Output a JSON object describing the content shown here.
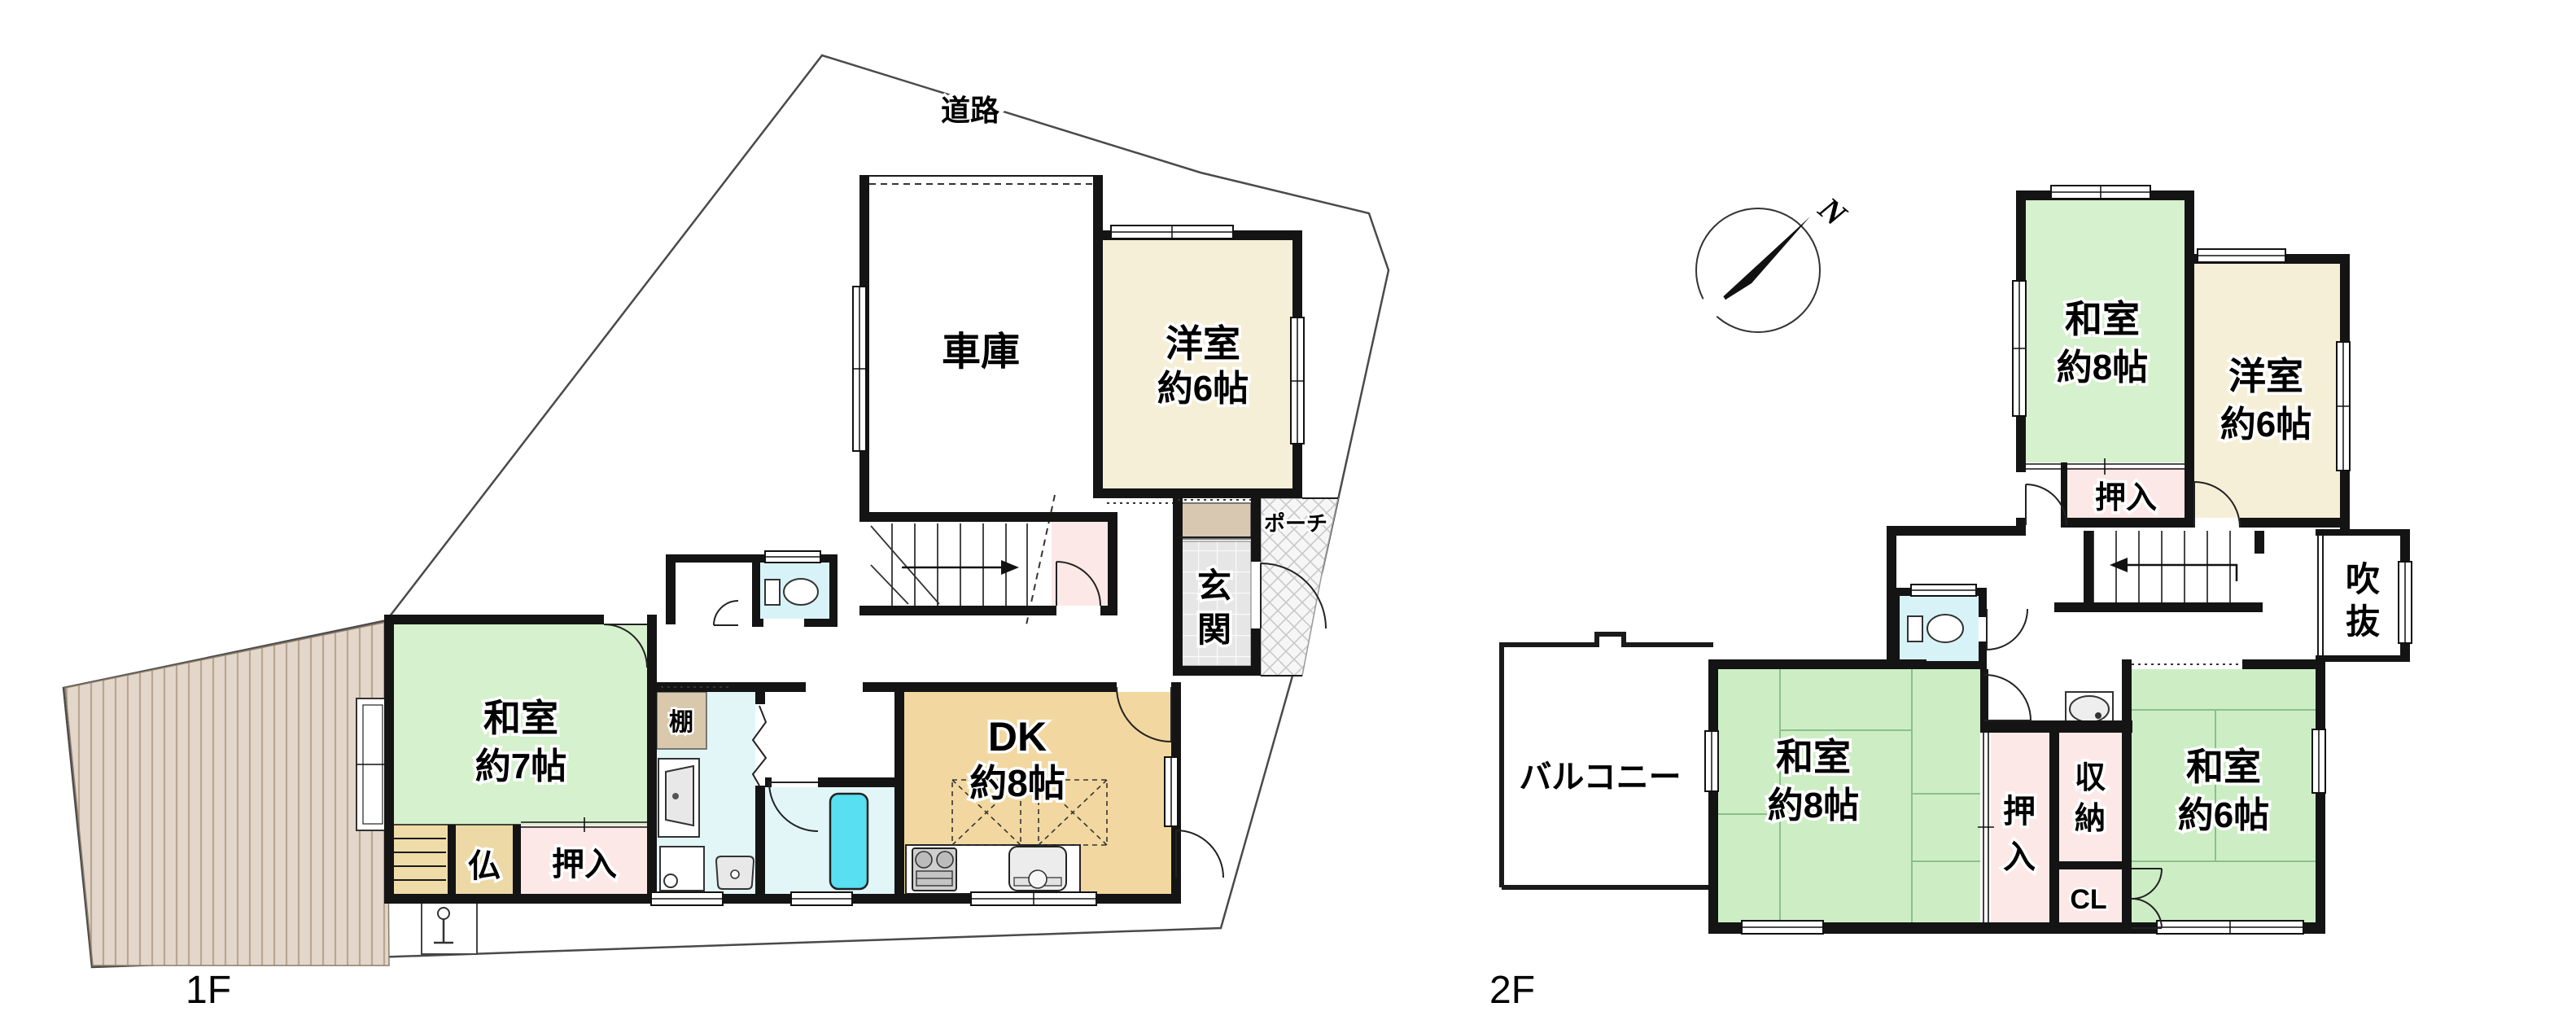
{
  "palette": {
    "wall": "#141414",
    "tatami_green": "#d5f1cd",
    "tatami_green_dark": "#cdeec5",
    "dk_wood": "#f2d8a0",
    "western_cream": "#f6efd7",
    "closet_pink": "#fce9e7",
    "toilet_cyan": "#d8f3f7",
    "wash_cyan": "#e2f6f8",
    "tub_cyan": "#58dff2",
    "shelf_tan": "#d9c8ac",
    "butsudan_tan": "#ecd9a6",
    "entry_tile": "#e6e6e6",
    "hatch_bg": "#e2d7ca",
    "hatch_line": "#b9a691"
  },
  "floor1": {
    "name": "1F",
    "road_label": "道路",
    "garage": "車庫",
    "western_room": {
      "line1": "洋室",
      "line2": "約6帖"
    },
    "dk": {
      "line1": "DK",
      "line2": "約8帖"
    },
    "japanese_room": {
      "line1": "和室",
      "line2": "約7帖"
    },
    "butsudan": "仏",
    "oshiire": "押入",
    "shelf": "棚",
    "genkan": {
      "line1": "玄",
      "line2": "関"
    },
    "porch": "ポーチ"
  },
  "floor2": {
    "name": "2F",
    "compass": "N",
    "japanese_room_north": {
      "line1": "和室",
      "line2": "約8帖"
    },
    "western_room": {
      "line1": "洋室",
      "line2": "約6帖"
    },
    "oshiire_north": "押入",
    "void_space": {
      "line1": "吹",
      "line2": "抜"
    },
    "balcony": "バルコニー",
    "japanese_room_west": {
      "line1": "和室",
      "line2": "約8帖"
    },
    "oshiire_center": {
      "line1": "押",
      "line2": "入"
    },
    "storage": {
      "line1": "収",
      "line2": "納"
    },
    "closet": "CL",
    "japanese_room_east": {
      "line1": "和室",
      "line2": "約6帖"
    }
  }
}
